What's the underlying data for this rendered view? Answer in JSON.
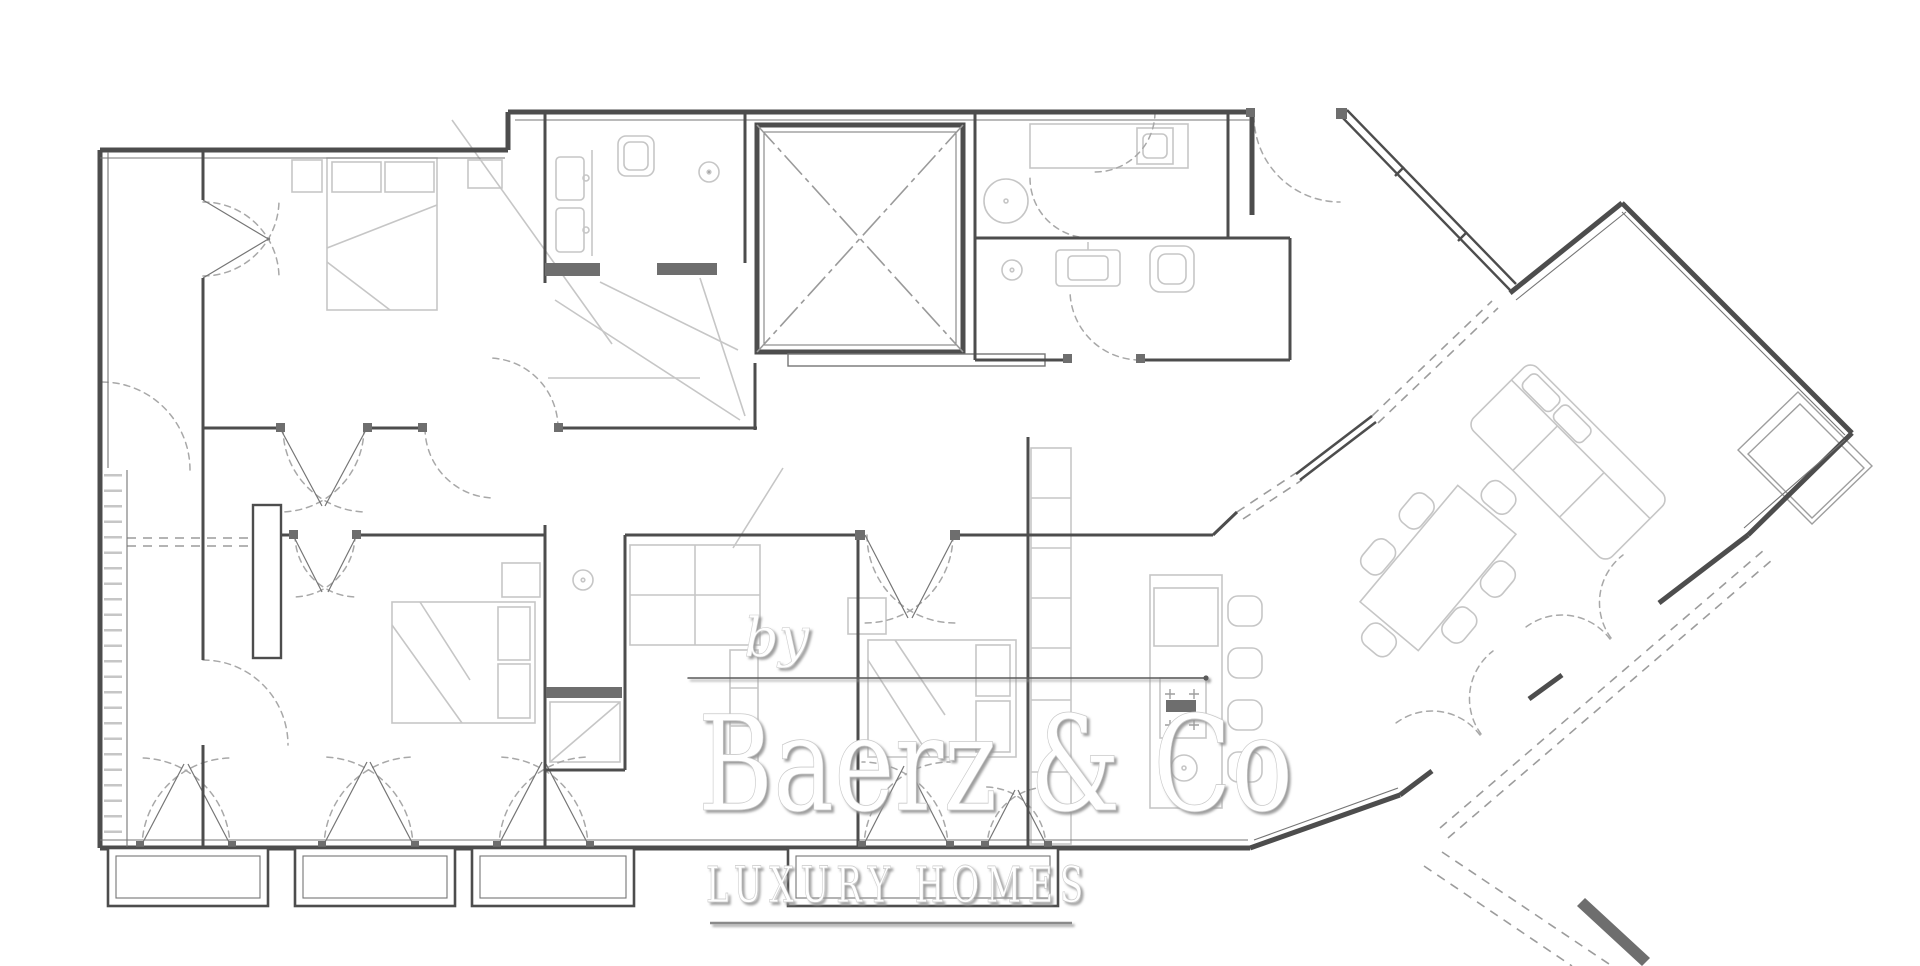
{
  "watermark": {
    "prefix": "by",
    "brand": "Baerz & Co",
    "tagline": "LUXURY HOMES"
  },
  "palette": {
    "background": "#ffffff",
    "wall": "#4d4d4d",
    "wall_thin": "#757575",
    "furniture": "#c6c6c6",
    "furniture_dark": "#9e9e9e",
    "door_arc": "#a8a8a8",
    "dashed_open": "#9c9c9c",
    "shaft_cross": "#9a9a9a",
    "dark_fixture": "#6e6e6e",
    "watermark_fill": "#ffffff",
    "watermark_shadow": "#999999",
    "rule_line": "#5a5a5a"
  }
}
